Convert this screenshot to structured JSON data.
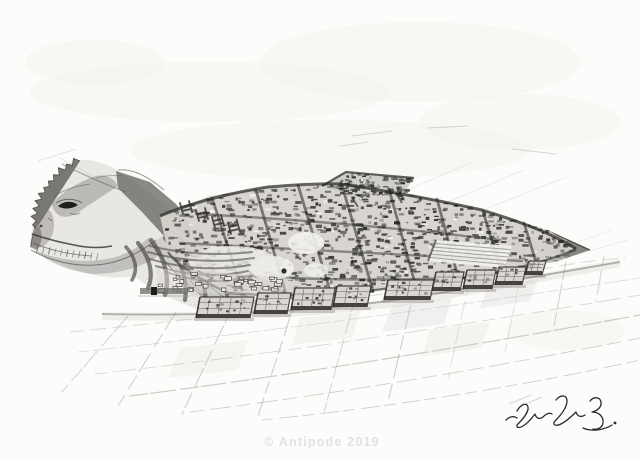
{
  "artwork": {
    "watermark_text": "© Antipode 2019",
    "palette": {
      "paper": "#fdfcfa",
      "ink_dark": "#2c2c2a",
      "ink_mid": "#55534f",
      "wash_gray": "#b5b3b0",
      "pencil_gray": "#a9a7a4",
      "watermark_gray": "#e3e2e0",
      "signature_ink": "#2a2a28"
    }
  }
}
